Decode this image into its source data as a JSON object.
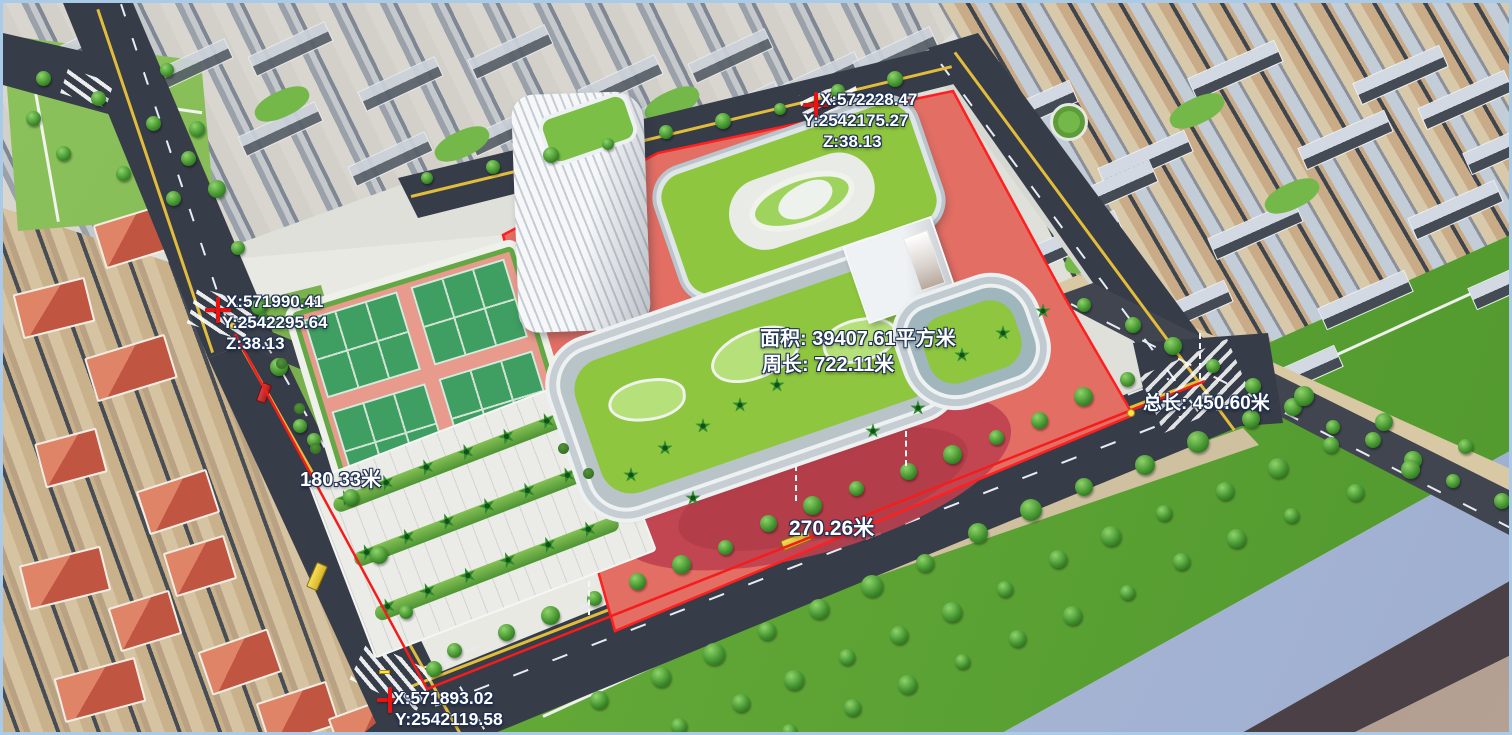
{
  "markers": [
    {
      "id": "north-point",
      "x_label": "X:572228.47",
      "y_label": "Y:2542175.27",
      "z_label": "Z:38.13"
    },
    {
      "id": "west-point",
      "x_label": "X:571990.41",
      "y_label": "Y:2542295.64",
      "z_label": "Z:38.13"
    },
    {
      "id": "south-point",
      "x_label": "X:571893.02",
      "y_label": "Y:2542119.58",
      "z_label": "Z:38.13"
    }
  ],
  "measurements": {
    "area_label": "面积: 39407.61平方米",
    "perimeter_label": "周长: 722.11米",
    "total_length_label": "总长: 450.60米",
    "segment_west_label": "180.33米",
    "segment_south_label": "270.26米"
  },
  "colors": {
    "selection_fill": "#e2574b",
    "selection_outline": "#ff1f1f",
    "marker_cross": "#e81414",
    "vertex_dot": "#ffe34a",
    "label_text": "#ffffff",
    "label_outline": "#1d3054",
    "frame": "#a9cbe8"
  }
}
